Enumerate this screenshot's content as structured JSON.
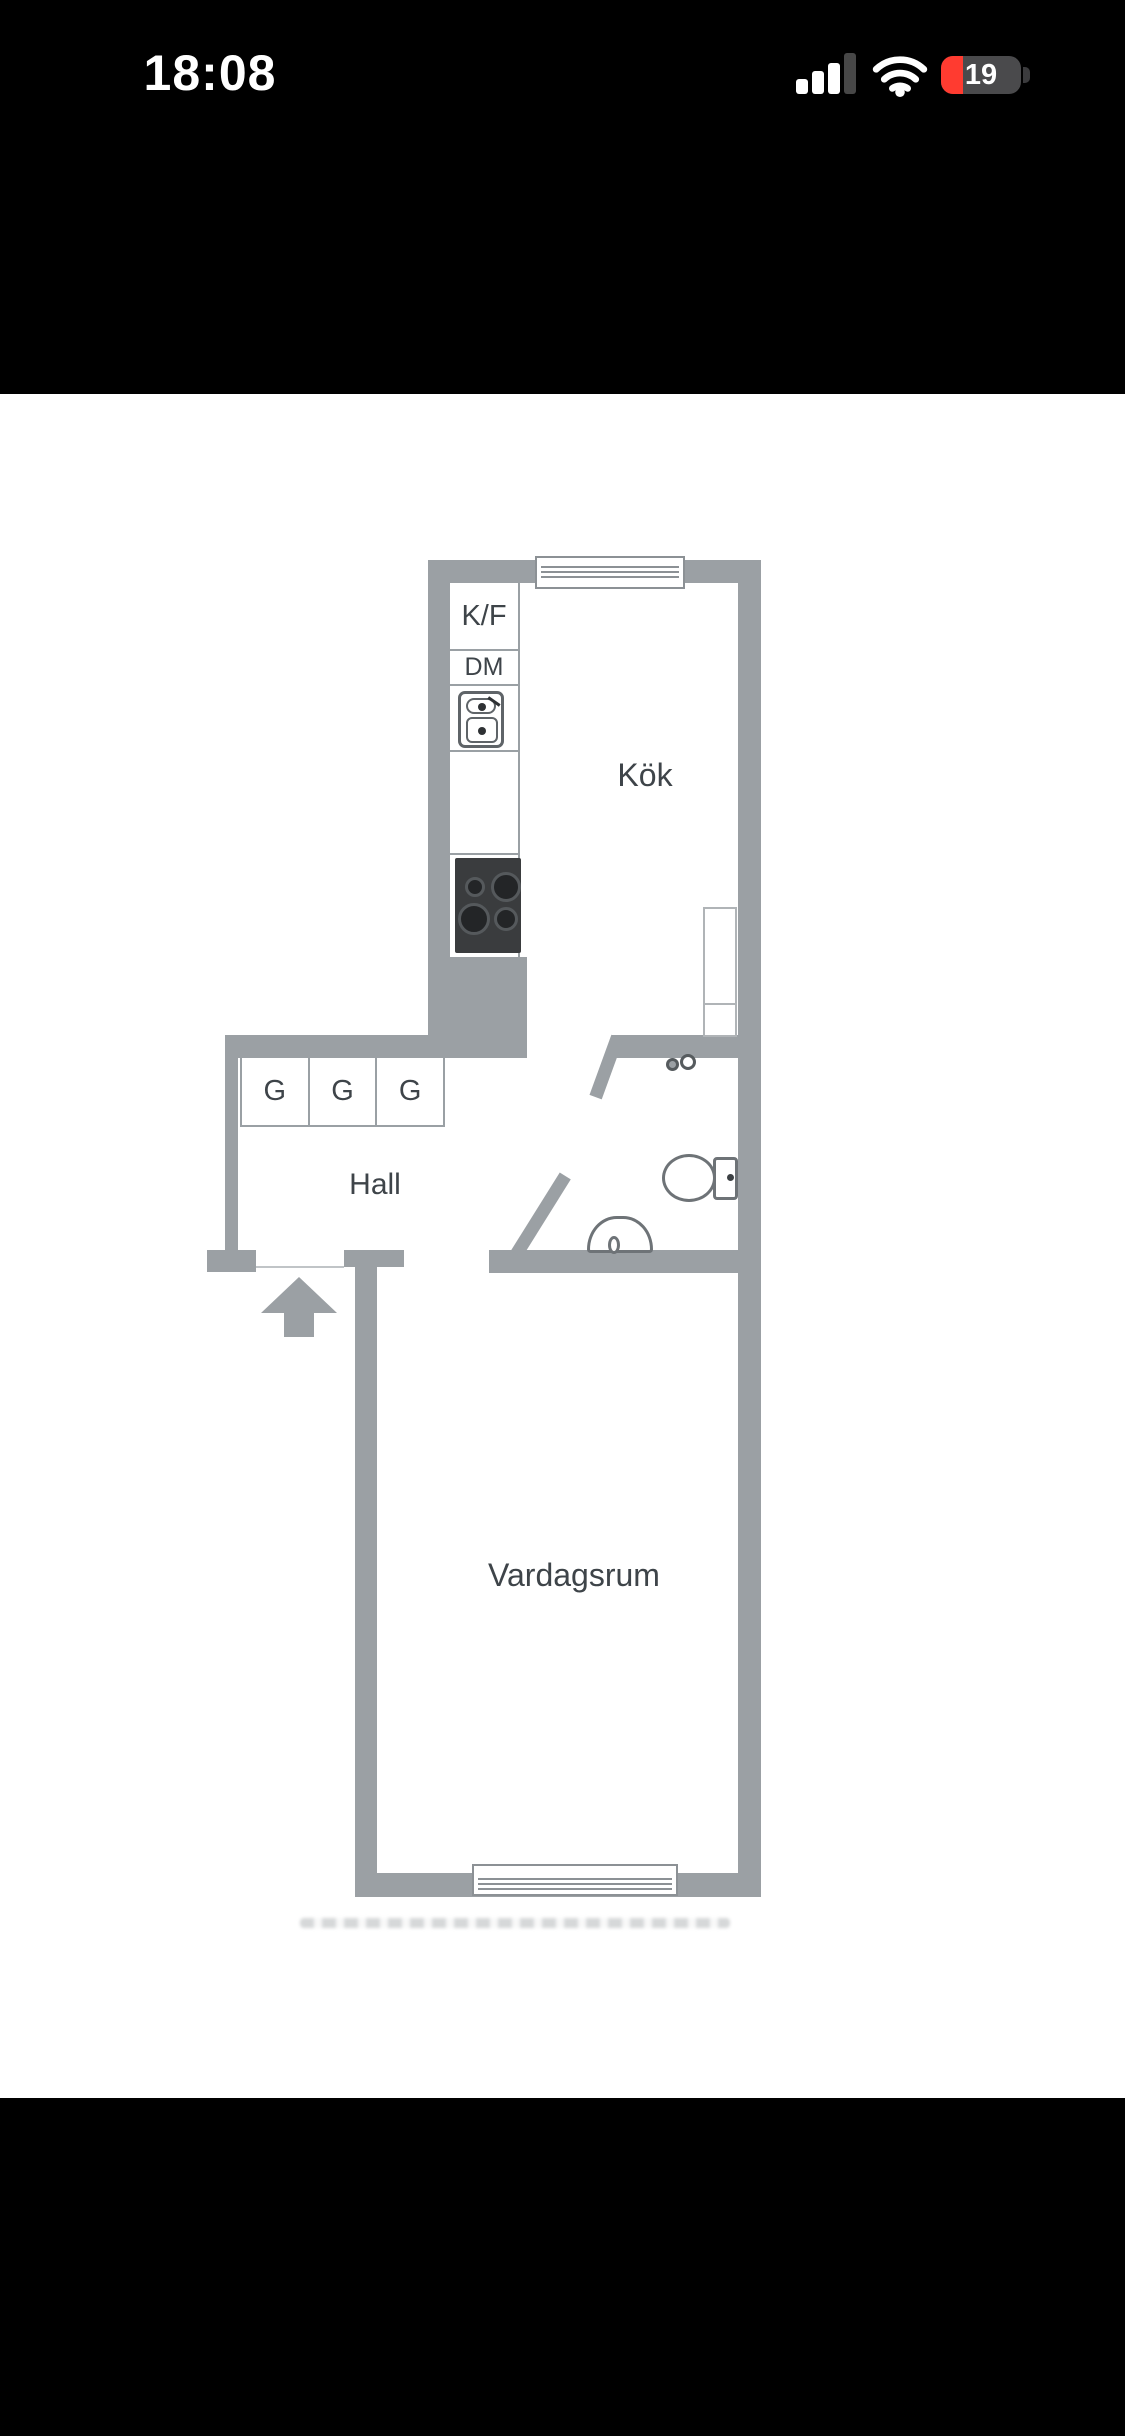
{
  "status_bar": {
    "time": "18:08",
    "battery_percent": "19",
    "icons": {
      "signal": "cellular-signal-3-of-4-bars",
      "wifi": "wifi-full",
      "battery": "battery-low-red"
    }
  },
  "floor_plan": {
    "rooms": {
      "kitchen": "Kök",
      "hall": "Hall",
      "living_room": "Vardagsrum"
    },
    "fixtures": {
      "fridge_freezer": "K/F",
      "dishwasher": "DM",
      "wardrobes": [
        "G",
        "G",
        "G"
      ]
    },
    "symbols": [
      "kitchen-sink",
      "stove-four-burners",
      "kitchen-cupboard",
      "toilet",
      "washbasin",
      "door-leaf-kitchen",
      "door-leaf-bathroom",
      "window-top",
      "window-bottom",
      "entrance-arrow"
    ],
    "colors": {
      "wall": "#9BA0A4",
      "label_text": "#3E4449",
      "fixture_outline": "#6E7377"
    }
  },
  "colors": {
    "letterbox_band": "#000000",
    "canvas": "#FFFFFF",
    "battery_red": "#FF3B30"
  }
}
